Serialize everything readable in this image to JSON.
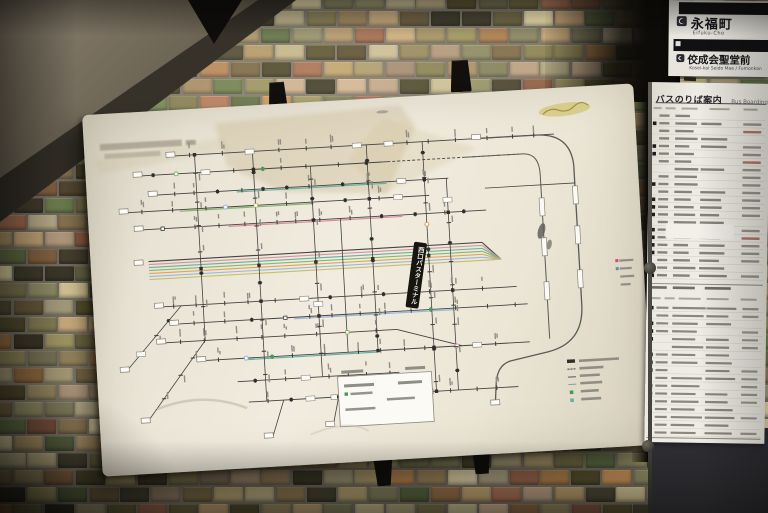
{
  "station_signs": {
    "sign1": {
      "name_jp": "永福町",
      "name_romaji": "Eifuku-Cho"
    },
    "sign2": {
      "name_jp": "佼成会聖堂前",
      "name_romaji": "Kosei-kai Seido Mae / Fumonkan"
    }
  },
  "boarding_guide": {
    "title_jp": "バスのりば案内",
    "title_en": "Bus Boarding Guide"
  },
  "route_map": {
    "terminal_banner_jp": "西口バスターミナル"
  },
  "palette": {
    "board_surface": "#ece7d9",
    "panel_surface": "#eceae2",
    "banner_bg": "#17150f",
    "route_line_colors": [
      "#434340",
      "#d6909e",
      "#66b0a4",
      "#84ba6b",
      "#e0a45c",
      "#94badb",
      "#c9bd69"
    ],
    "stop_green": "#3f9e57",
    "tile_colors": [
      "#7b744d",
      "#5c5636",
      "#b3a272",
      "#c6b88c",
      "#6e5f41",
      "#b29a7e",
      "#a09764",
      "#82805c",
      "#4c4733",
      "#ab9265",
      "#cabf94",
      "#66744a",
      "#96704b",
      "#8e8a67",
      "#bfa377",
      "#56502f",
      "#b5854f",
      "#9c6a4f",
      "#403d2c",
      "#cfc39b"
    ]
  }
}
